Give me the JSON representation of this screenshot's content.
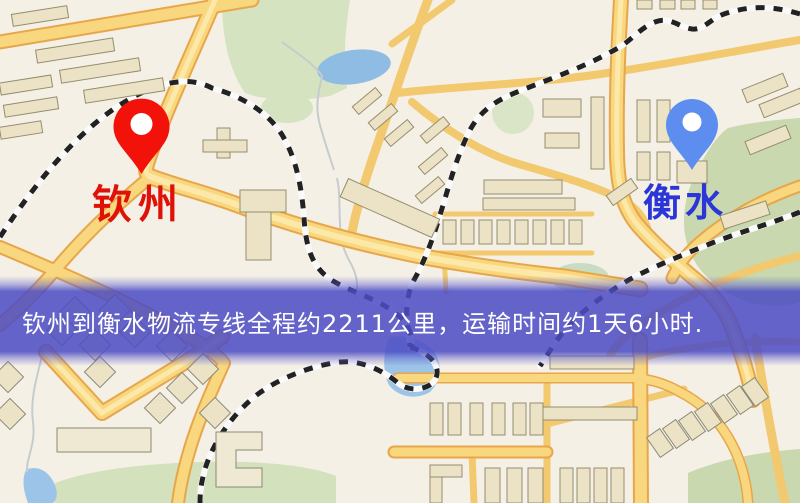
{
  "map": {
    "type": "logistics-route-map",
    "origin": {
      "label": "钦州",
      "pin_color": "#f2120a",
      "label_color": "#e01207"
    },
    "destination": {
      "label": "衡水",
      "pin_color": "#5d8eef",
      "label_color": "#2b36d8"
    },
    "banner": {
      "text": "钦州到衡水物流专线全程约2211公里，运输时间约1天6小时.",
      "distance_km": "2211",
      "duration": "1天6小时",
      "bg_color": "#4c4cc4",
      "text_color": "#ffffff"
    },
    "legend_colors": {
      "background": "#f5f0e6",
      "road": "#f8d77f",
      "road_casing": "#e8a64b",
      "building": "#ece3c6",
      "building_stroke": "#958d6d",
      "park_green": "#d3e1bc",
      "water_blue": "#8fbce3",
      "railway": "#222222"
    }
  }
}
